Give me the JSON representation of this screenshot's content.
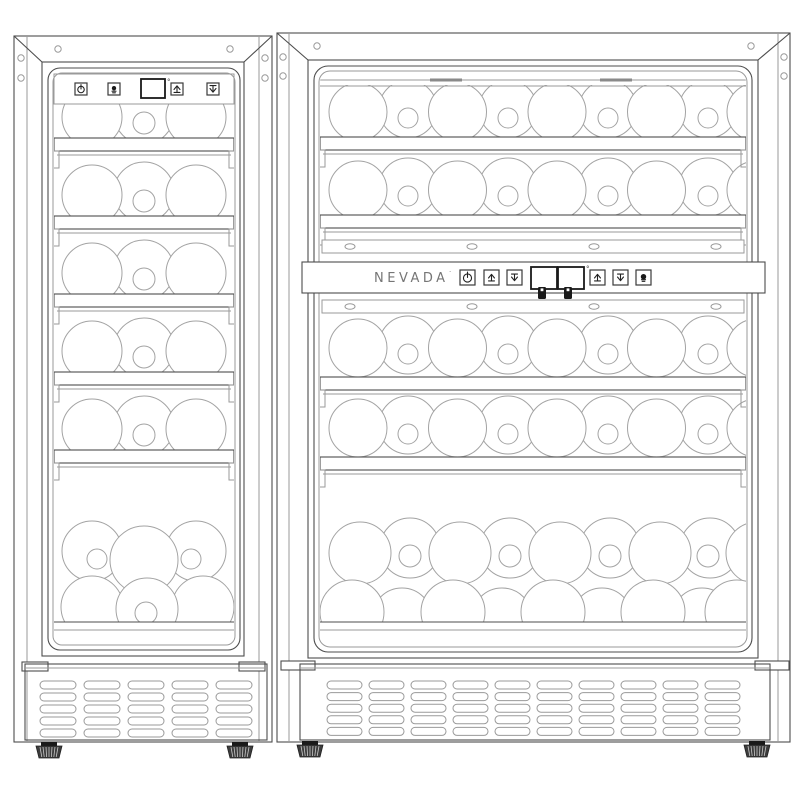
{
  "drawing": {
    "name": "wine-cooler-pair-technical-drawing",
    "colors": {
      "line": "#4d4d4d",
      "line_light": "#9a9a9a",
      "bottle_line": "#a3a3a3",
      "dark": "#1a1a1a",
      "brand_text": "#767676",
      "foot_fill": "#3c3c3c",
      "background": "#ffffff"
    },
    "left_unit": {
      "name": "single-zone-wine-cooler",
      "control_panel": {
        "degree_mark": "°",
        "controls": [
          {
            "name": "power-button",
            "icon": "power-icon"
          },
          {
            "name": "light-button",
            "icon": "light-icon"
          },
          {
            "name": "temperature-display",
            "type": "display",
            "value": ""
          },
          {
            "name": "temp-up-button",
            "icon": "arrow-up-icon"
          },
          {
            "name": "temp-down-button",
            "icon": "arrow-down-icon"
          }
        ]
      },
      "shelves": {
        "count": 5
      },
      "bottle_rows": {
        "on_shelves": 5,
        "front_per_row": 2,
        "back_per_row": 1,
        "necks_per_row": 1,
        "bottom_stack_rows": 2
      },
      "frame_screw_holes": {
        "top": 2,
        "left_side": 2,
        "right_side": 2
      },
      "vent_grille": {
        "columns": 5,
        "rows": 5
      },
      "feet": {
        "count": 2
      }
    },
    "right_unit": {
      "name": "dual-zone-wine-cooler",
      "brand_label": "NEVADA",
      "brand_mark": "·",
      "control_bar": {
        "degree_mark": "°",
        "controls": [
          {
            "name": "power-button",
            "icon": "power-icon"
          },
          {
            "name": "upper-temp-up-button",
            "icon": "arrow-up-icon"
          },
          {
            "name": "upper-temp-down-button",
            "icon": "arrow-down-icon"
          },
          {
            "name": "upper-zone-display",
            "type": "display",
            "value": ""
          },
          {
            "name": "lower-zone-display",
            "type": "display",
            "value": ""
          },
          {
            "name": "lower-temp-up-button",
            "icon": "arrow-up-icon"
          },
          {
            "name": "lower-temp-down-button",
            "icon": "arrow-down-icon"
          },
          {
            "name": "light-button",
            "icon": "light-icon"
          }
        ],
        "zone_icons": [
          {
            "name": "upper-zone-bottle-icon",
            "icon": "bottle-icon"
          },
          {
            "name": "lower-zone-bottle-icon",
            "icon": "bottle-icon"
          }
        ]
      },
      "hinge_strips": {
        "count": 2,
        "screws_each": 4
      },
      "shelves": {
        "count": 4
      },
      "bottle_rows": {
        "above_bar": 2,
        "below_bar": 2,
        "front_per_row": 5,
        "back_per_row": 4,
        "necks_per_row": 4,
        "bottom_stack_rows": 2
      },
      "frame_screw_holes": {
        "top": 2,
        "left_side": 2,
        "right_side": 2
      },
      "vent_grille": {
        "columns": 10,
        "rows": 5
      },
      "feet": {
        "count": 2
      }
    }
  }
}
